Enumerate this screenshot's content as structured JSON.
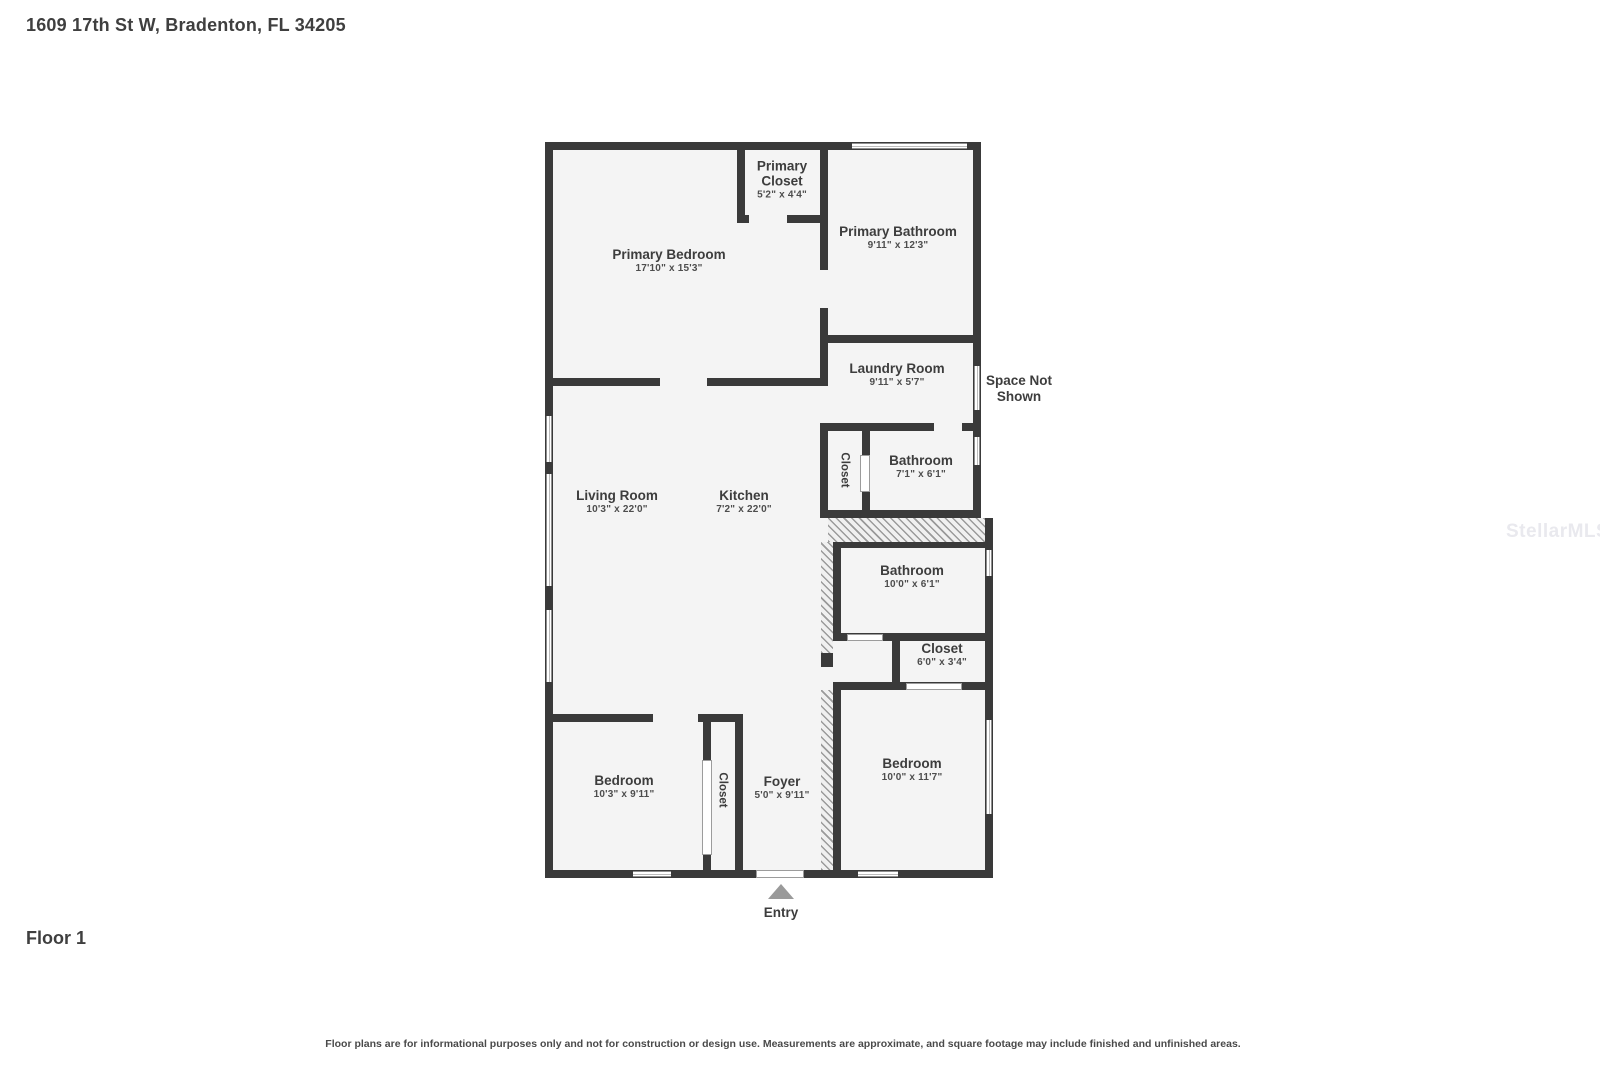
{
  "page": {
    "title": "1609 17th St W, Bradenton, FL 34205",
    "floor_label": "Floor 1",
    "disclaimer": "Floor plans are for informational purposes only and not for construction or design use. Measurements are approximate, and square footage may include finished and unfinished areas.",
    "watermark": "StellarMLS"
  },
  "plan": {
    "entry_label": "Entry",
    "space_not_shown": "Space Not Shown",
    "rooms": {
      "primary_closet": {
        "name": "Primary Closet",
        "dims": "5'2\" x 4'4\""
      },
      "primary_bedroom": {
        "name": "Primary Bedroom",
        "dims": "17'10\" x 15'3\""
      },
      "primary_bathroom": {
        "name": "Primary Bathroom",
        "dims": "9'11\" x 12'3\""
      },
      "laundry_room": {
        "name": "Laundry Room",
        "dims": "9'11\" x 5'7\""
      },
      "closet_hall": {
        "name": "Closet"
      },
      "bathroom_hall": {
        "name": "Bathroom",
        "dims": "7'1\" x 6'1\""
      },
      "living_room": {
        "name": "Living Room",
        "dims": "10'3\" x 22'0\""
      },
      "kitchen": {
        "name": "Kitchen",
        "dims": "7'2\" x 22'0\""
      },
      "bathroom_main": {
        "name": "Bathroom",
        "dims": "10'0\" x 6'1\""
      },
      "closet_main": {
        "name": "Closet",
        "dims": "6'0\" x 3'4\""
      },
      "bedroom_left": {
        "name": "Bedroom",
        "dims": "10'3\" x 9'11\""
      },
      "closet_bedroom": {
        "name": "Closet"
      },
      "foyer": {
        "name": "Foyer",
        "dims": "5'0\" x 9'11\""
      },
      "bedroom_right": {
        "name": "Bedroom",
        "dims": "10'0\" x 11'7\""
      }
    }
  }
}
